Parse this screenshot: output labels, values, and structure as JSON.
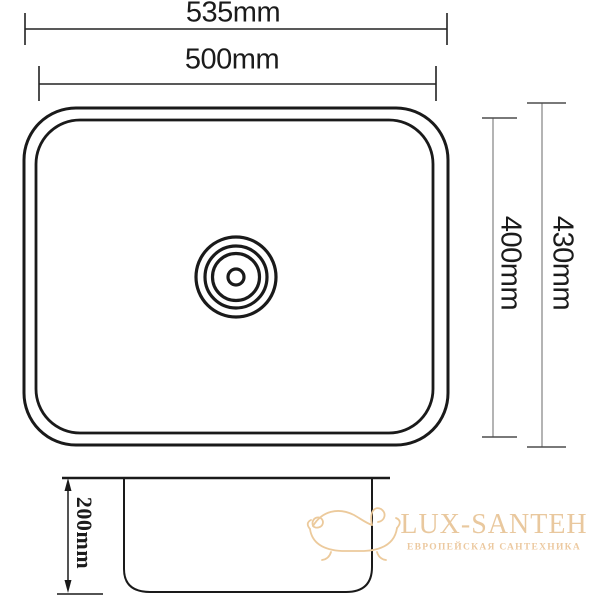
{
  "drawing": {
    "type": "sink-dimension-diagram",
    "colors": {
      "line": "#1a1a1a",
      "dim_gray": "#8c8c8c",
      "tick_dark": "#4d4d4d",
      "text": "#1b1b1b"
    },
    "dimensions": {
      "top_outer_width": "535mm",
      "top_inner_width": "500mm",
      "right_inner_height": "400mm",
      "right_outer_height": "430mm",
      "depth": "200mm"
    },
    "watermark": {
      "brand": "LUX-SANTEH",
      "tagline": "ЕВРОПЕЙСКАЯ САНТЕХНИКА",
      "brand_color": "#e9c89e",
      "tagline_color": "#ecc9a0",
      "icon": "bathtub-icon"
    }
  }
}
